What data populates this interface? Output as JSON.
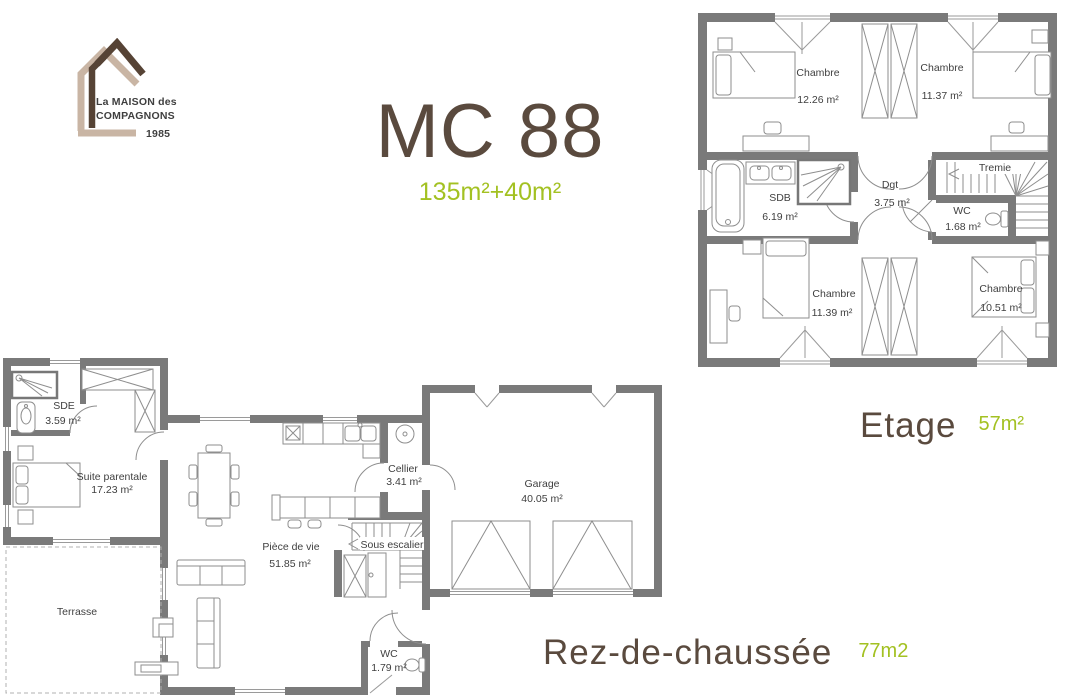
{
  "logo": {
    "line1": "La MAISON des",
    "line2": "COMPAGNONS",
    "year": "1985"
  },
  "header": {
    "title": "MC 88",
    "subtitle": "135m²+40m²"
  },
  "colors": {
    "brand_brown": "#5a4a3e",
    "brand_green": "#a3c122",
    "logo_beige": "#c9b5a4",
    "logo_dark_brown": "#564335",
    "wall_gray": "#7a7a7a",
    "furniture_gray": "#8e8e8e",
    "plan_text": "#3f3f3f"
  },
  "etage": {
    "label": "Etage",
    "area": "57m²",
    "rooms": [
      {
        "name": "Chambre",
        "area": "12.26 m²"
      },
      {
        "name": "Chambre",
        "area": "11.37 m²"
      },
      {
        "name": "SDB",
        "area": "6.19 m²"
      },
      {
        "name": "Dgt",
        "area": "3.75 m²"
      },
      {
        "name": "Tremie",
        "area": ""
      },
      {
        "name": "WC",
        "area": "1.68 m²"
      },
      {
        "name": "Chambre",
        "area": "11.39 m²"
      },
      {
        "name": "Chambre",
        "area": "10.51 m²"
      }
    ]
  },
  "rdc": {
    "label": "Rez-de-chaussée",
    "area": "77m2",
    "rooms": [
      {
        "name": "SDE",
        "area": "3.59 m²"
      },
      {
        "name": "Suite parentale",
        "area": "17.23 m²"
      },
      {
        "name": "Cellier",
        "area": "3.41 m²"
      },
      {
        "name": "Pièce de vie",
        "area": "51.85 m²"
      },
      {
        "name": "Sous escalier",
        "area": ""
      },
      {
        "name": "Garage",
        "area": "40.05 m²"
      },
      {
        "name": "WC",
        "area": "1.79 m²"
      },
      {
        "name": "Terrasse",
        "area": ""
      }
    ]
  }
}
